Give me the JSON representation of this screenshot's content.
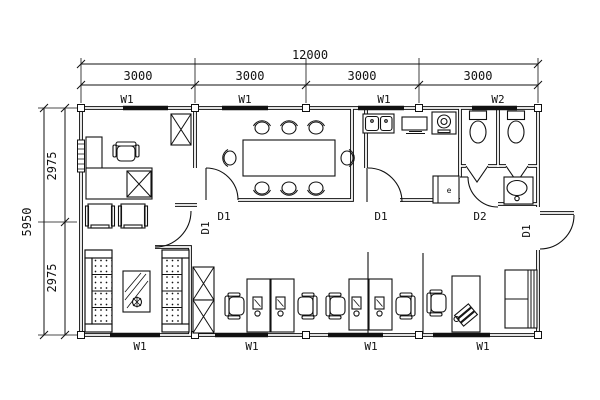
{
  "meta": {
    "background_color": "#ffffff",
    "line_color": "#111111",
    "drawing_type": "office floor plan"
  },
  "dimensions": {
    "total_width": "12000",
    "bay_width": "3000",
    "total_height": "5950",
    "half_height": "2975"
  },
  "labels": {
    "window_w1": "W1",
    "window_w2": "W2",
    "door_d1": "D1",
    "door_d2": "D2",
    "fridge": "e"
  }
}
